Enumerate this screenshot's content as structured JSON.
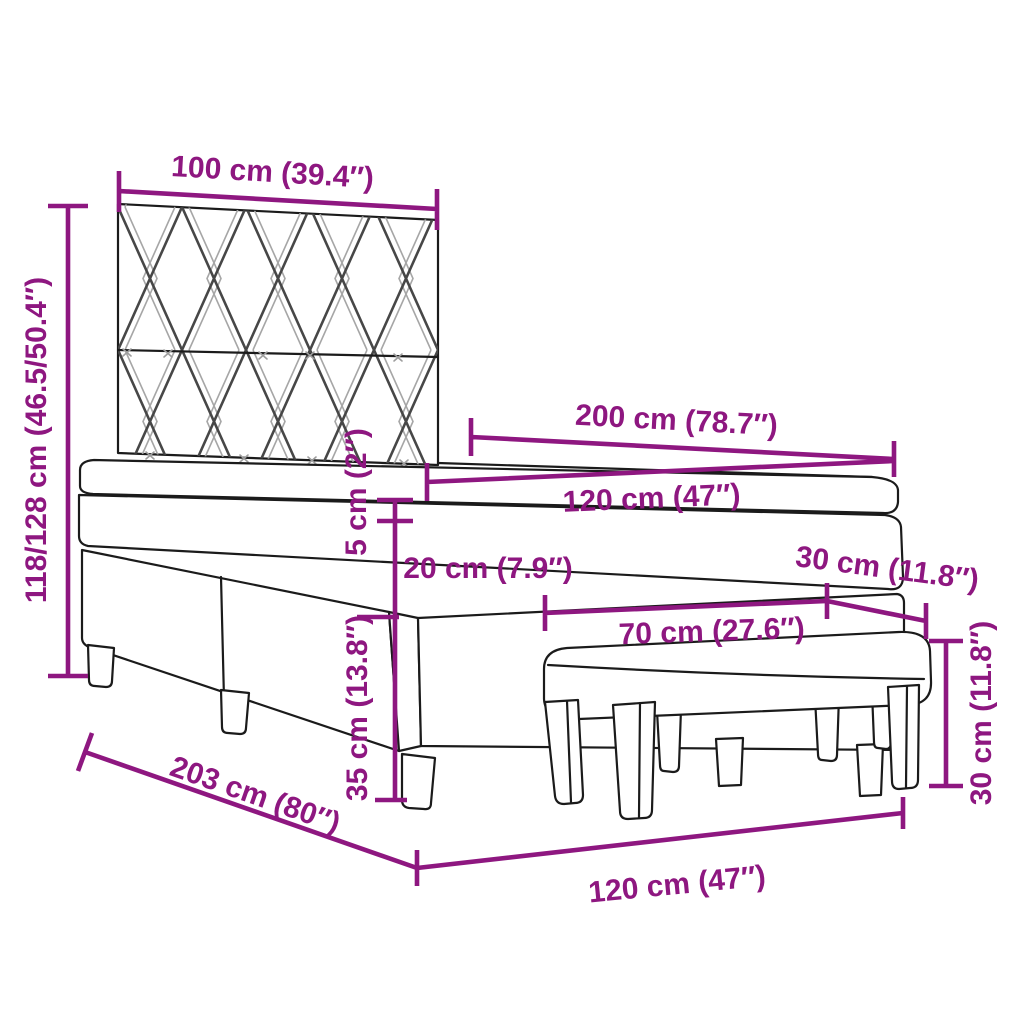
{
  "diagram": {
    "kind": "product-dimension-diagram",
    "subject": "box-spring-bed-with-headboard-topper-and-bench",
    "accent_color": "#8E1780",
    "outline_color": "#1b1b1b",
    "background_color": "#ffffff",
    "labels": {
      "headboard_width": "100 cm (39.4″)",
      "headboard_height": "118/128 cm (46.5/50.4″)",
      "bed_length": "200 cm (78.7″)",
      "mattress_width": "120 cm (47″)",
      "topper_thickness": "5 cm (2″)",
      "mattress_thickness": "20 cm (7.9″)",
      "base_height": "35 cm (13.8″)",
      "bench_length": "70 cm (27.6″)",
      "bench_depth": "30 cm (11.8″)",
      "bench_height": "30 cm (11.8″)",
      "frame_length": "203 cm (80″)",
      "bed_width": "120 cm (47″)"
    }
  }
}
